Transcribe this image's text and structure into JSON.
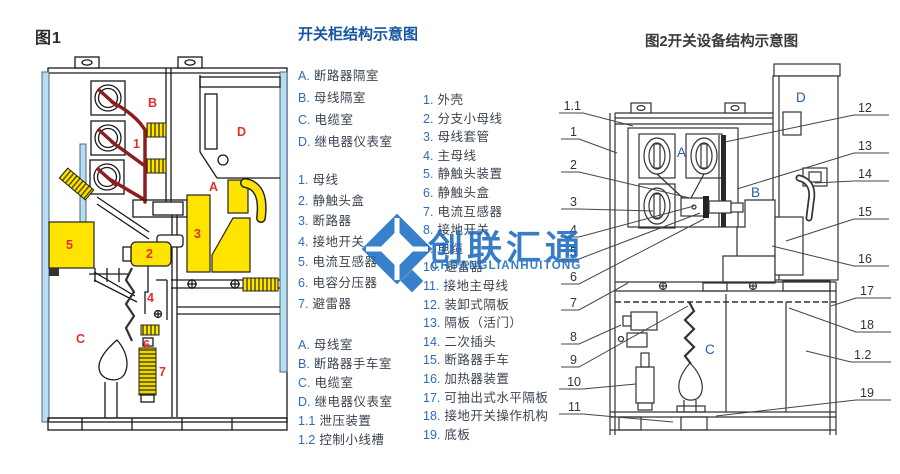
{
  "fig1": {
    "caption": "图1",
    "compartments": {
      "a": "A",
      "b": "B",
      "c": "C",
      "d": "D"
    },
    "parts": {
      "p1": "1",
      "p2": "2",
      "p3": "3",
      "p4": "4",
      "p5": "5",
      "p6": "6",
      "p7": "7"
    }
  },
  "legend": {
    "title": "开关柜结构示意图",
    "c1a": [
      {
        "n": "A.",
        "t": "断路器隔室"
      },
      {
        "n": "B.",
        "t": "母线隔室"
      },
      {
        "n": "C.",
        "t": "电缆室"
      },
      {
        "n": "D.",
        "t": "继电器仪表室"
      }
    ],
    "c1b": [
      {
        "n": "1.",
        "t": "母线"
      },
      {
        "n": "2.",
        "t": "静触头盒"
      },
      {
        "n": "3.",
        "t": "断路器"
      },
      {
        "n": "4.",
        "t": "接地开关"
      },
      {
        "n": "5.",
        "t": "电流互感器"
      },
      {
        "n": "6.",
        "t": "电容分压器"
      },
      {
        "n": "7.",
        "t": "避雷器"
      }
    ],
    "c1c": [
      {
        "n": "A.",
        "t": "母线室"
      },
      {
        "n": "B.",
        "t": "断路器手车室"
      },
      {
        "n": "C.",
        "t": "电缆室"
      },
      {
        "n": "D.",
        "t": "继电器仪表室"
      },
      {
        "n": "1.1",
        "t": "泄压装置"
      },
      {
        "n": "1.2",
        "t": "控制小线槽"
      }
    ],
    "c2": [
      {
        "n": "1.",
        "t": "外壳"
      },
      {
        "n": "2.",
        "t": "分支小母线"
      },
      {
        "n": "3.",
        "t": "母线套管"
      },
      {
        "n": "4.",
        "t": "主母线"
      },
      {
        "n": "5.",
        "t": "静触头装置"
      },
      {
        "n": "6.",
        "t": "静触头盒"
      },
      {
        "n": "7.",
        "t": "电流互感器"
      },
      {
        "n": "8.",
        "t": "接地开关"
      },
      {
        "n": "9.",
        "t": "电缆"
      },
      {
        "n": "10.",
        "t": "避雷器"
      },
      {
        "n": "11.",
        "t": "接地主母线"
      },
      {
        "n": "12.",
        "t": "装卸式隔板"
      },
      {
        "n": "13.",
        "t": "隔板（活门）"
      },
      {
        "n": "14.",
        "t": "二次插头"
      },
      {
        "n": "15.",
        "t": "断路器手车"
      },
      {
        "n": "16.",
        "t": "加热器装置"
      },
      {
        "n": "17.",
        "t": "可抽出式水平隔板"
      },
      {
        "n": "18.",
        "t": "接地开关操作机构"
      },
      {
        "n": "19.",
        "t": "底板"
      }
    ]
  },
  "fig2": {
    "title": "图2开关设备结构示意图",
    "compartments": {
      "a": "A",
      "b": "B",
      "c": "C",
      "d": "D"
    },
    "left_callouts": [
      "1.1",
      "1",
      "2",
      "3",
      "4",
      "5",
      "6",
      "7",
      "8",
      "9",
      "10",
      "11"
    ],
    "right_callouts": [
      "12",
      "13",
      "14",
      "15",
      "16",
      "17",
      "18",
      "1.2",
      "19"
    ]
  },
  "watermark": {
    "text": "创联汇通",
    "subtext": "CHUANGLIANHUITONG"
  },
  "colors": {
    "accent_blue": "#2e6cb8",
    "title_blue": "#16569e",
    "label_red": "#e0312b",
    "busbar_dark_red": "#8b1e1e",
    "component_yellow": "#ffe400",
    "panel_light_blue": "#b8dcf0",
    "watermark_blue": "#1b6ac0",
    "line_dark": "#333333"
  }
}
